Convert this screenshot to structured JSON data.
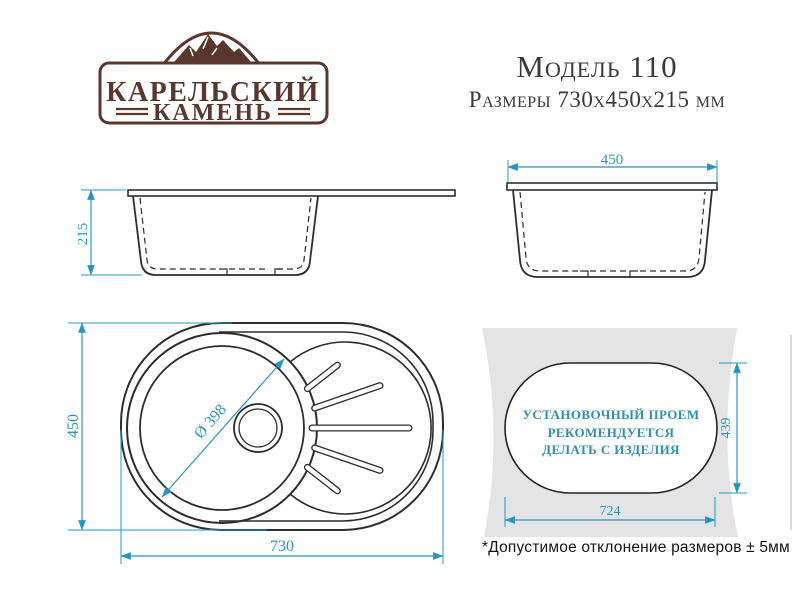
{
  "brand": {
    "name_line1": "КАРЕЛЬСКИЙ",
    "name_line2": "КАМЕНЬ"
  },
  "header": {
    "model": "Модель 110",
    "size_line": "Размеры 730х450х215 мм"
  },
  "views": {
    "side": {
      "depth_mm": "215"
    },
    "front": {
      "width_mm": "450"
    },
    "top": {
      "length_mm": "730",
      "width_mm": "450",
      "bowl_diameter": "Ø 398"
    },
    "cutout": {
      "length_mm": "724",
      "height_mm": "439",
      "note_line1": "УСТАНОВОЧНЫЙ ПРОЕМ",
      "note_line2": "РЕКОМЕНДУЕТСЯ",
      "note_line3": "ДЕЛАТЬ С ИЗДЕЛИЯ"
    }
  },
  "footnote": "*Допустимое отклонение размеров ± 5мм",
  "colors": {
    "dimension_accent": "#2b95c1",
    "brand_brown": "#5a372e",
    "note_text": "#2e8fae",
    "countertop_gray": "#e4e4e4",
    "drawing_line": "#2d2d2d"
  }
}
